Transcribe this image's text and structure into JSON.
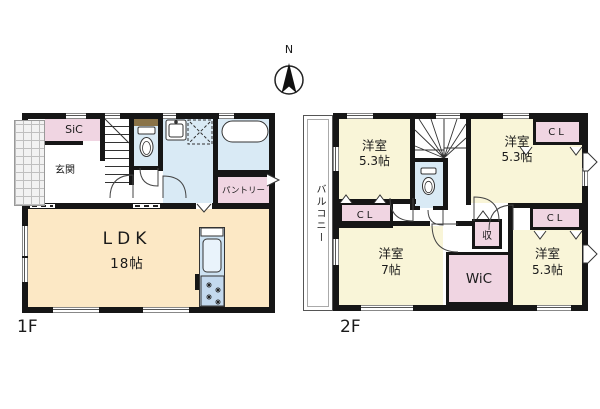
{
  "compass": {
    "label": "N"
  },
  "floor1": {
    "floor_label": "1F",
    "rooms": {
      "sic": {
        "label": "SiC"
      },
      "genkan": {
        "label": "玄関"
      },
      "pantry": {
        "label": "パントリー"
      },
      "ldk": {
        "label": "LDK",
        "size": "18帖"
      }
    }
  },
  "floor2": {
    "floor_label": "2F",
    "rooms": {
      "balcony": {
        "label": "バルコニー"
      },
      "bedroom_nw": {
        "label": "洋室",
        "size": "5.3帖"
      },
      "bedroom_ne": {
        "label": "洋室",
        "size": "5.3帖"
      },
      "bedroom_sw": {
        "label": "洋室",
        "size": "7帖"
      },
      "bedroom_se": {
        "label": "洋室",
        "size": "5.3帖"
      },
      "closet_nw": {
        "label": "CL"
      },
      "closet_ne": {
        "label": "CL"
      },
      "closet_e": {
        "label": "CL"
      },
      "wic": {
        "label": "WiC"
      },
      "storage": {
        "label": "収"
      }
    }
  },
  "colors": {
    "wall": "#161616",
    "room-cream": "#fce8c5",
    "room-yellow": "#f9f5d8",
    "closet-pink": "#f0d5e2",
    "wet-blue": "#d9eaf5",
    "kitchen-blue": "#cde2f2",
    "shelf-brown": "#8a7348"
  }
}
